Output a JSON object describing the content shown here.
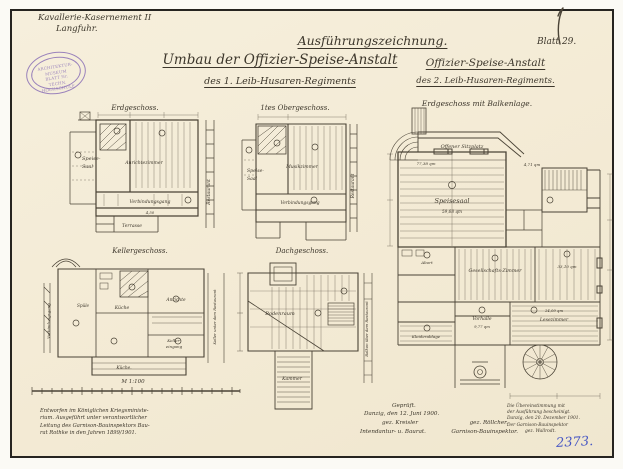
{
  "colors": {
    "paper": "#f4ecd8",
    "ink": "#4a4336",
    "stamp_purple": "#8b70b6",
    "blue_ink": "#4757c4",
    "accent_teal": "#8fd2cc",
    "accent_yellow": "#e3c44d"
  },
  "header": {
    "project_line1": "Kavallerie-Kasernement II",
    "project_line2": "Langfuhr.",
    "stamp_line1": "ARCHITEKTUR-MUSEUM",
    "stamp_line2": "BLATT Nr.",
    "stamp_line3": "TECHN. HOCHSCHULE",
    "title_main": "Umbau der Offizier-Speise-Anstalt",
    "title_main_sub": "des 1. Leib-Husaren-Regiments",
    "drawing_type": "Ausführungszeichnung.",
    "right_title": "Offizier-Speise-Anstalt",
    "right_subtitle": "des 2. Leib-Husaren-Regiments.",
    "sheet_no": "Blatt 29."
  },
  "plans": {
    "p1": {
      "title": "Erdgeschoss.",
      "speisesaal_a": "Speise-",
      "speisesaal_b": "Saal",
      "room_mid": "Anrichtezimmer",
      "corridor": "Verbindungsgang",
      "dim": "4,50",
      "right_side": "Restaurant",
      "bottom": "Terrasse"
    },
    "p2": {
      "title": "1tes Obergeschoss.",
      "left_a": "Speise-",
      "left_b": "Saal",
      "room_mid": "Musikzimmer",
      "corridor": "Verbindungsgang",
      "right_side": "Restaurant"
    },
    "p3": {
      "title": "Kellergeschoss.",
      "room_spuele": "Spüle",
      "room_kueche": "Küche",
      "room_anrichte": "Anrichte",
      "room_keller_a": "Keller-",
      "room_keller_b": "eingang",
      "left_side": "Verbindungsgang",
      "right_side": "Keller unter dem Restaurant",
      "bottom": "Küche."
    },
    "p4": {
      "title": "Dachgeschoss.",
      "room_main": "Bodenraum",
      "room_lower": "Kammer",
      "right_side": "Balkon über dem Restaurant"
    },
    "p5": {
      "title": "Erdgeschoss mit Balkenlage.",
      "sitzplatz": "Offener Sitzplatz",
      "sitzplatz_qm": "77,38 qm",
      "saal": "Speisesaal",
      "saal_qm": "59,68 qm",
      "stair_qm": "4,71 qm",
      "gesellschaft": "Gesellschafts-Zimmer",
      "right_room_qm": "33,10 qm",
      "abort": "Abort",
      "vorhalle": "Vorhalle",
      "vorhalle_qm": "9,77 qm",
      "lesezimmer_qm": "24,09 qm",
      "lesezimmer": "Lesezimmer",
      "kleiderablage": "Kleiderablage"
    }
  },
  "footer": {
    "scale_label": "M 1:100",
    "note_left": [
      "Entworfen im Königlichen Kriegsministe-",
      "rium. Ausgeführt unter verantwortlicher",
      "Leitung des Garnison-Bauinspektors Bau-",
      "rat Rothke in den Jahren 1899/1901."
    ],
    "checked": "Geprüft.",
    "checked_place": "Danzig, den 12. Juni 1900.",
    "sig_left": "gez. Kreisler",
    "sig_right": "gez. Röllcher.",
    "role_left": "Intendantur- u. Baurat.",
    "role_right": "Garnison-Bauinspektor.",
    "certification": [
      "Die Übereinstimmung mit",
      "der Ausführung bescheinigt.",
      "Danzig, den 20. Dezember 1901.",
      "Der Garnison-Bauinspektor",
      "gez. Wallrodt."
    ],
    "inventory_no": "2373."
  }
}
